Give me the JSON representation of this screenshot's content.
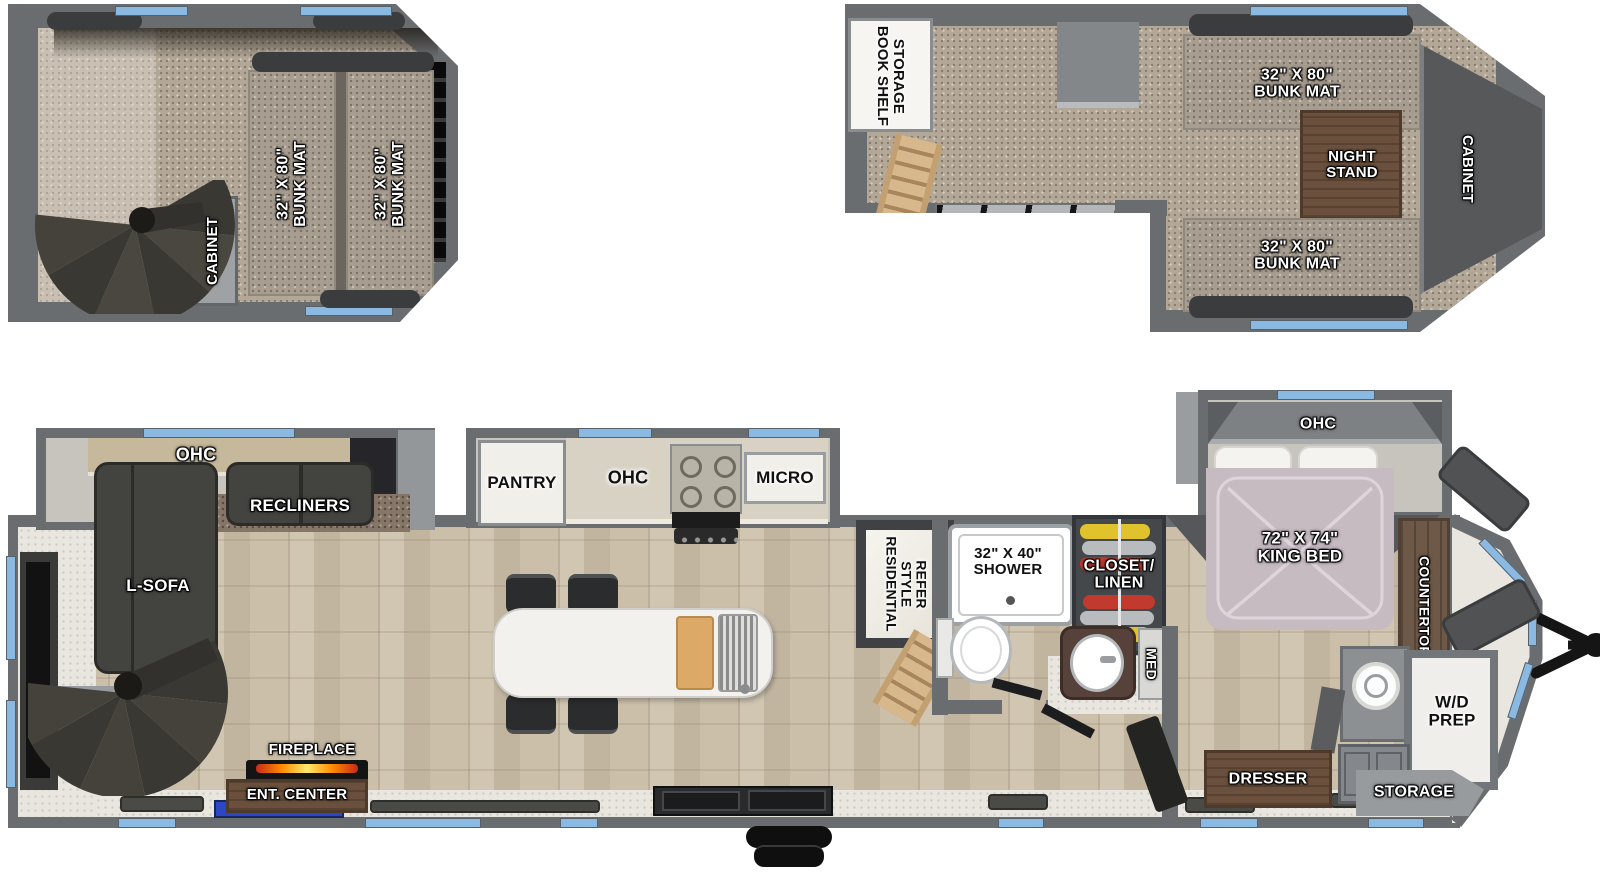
{
  "floorplan": {
    "rear_loft": {
      "cabinet": "CABINET",
      "bunk_left": "32\" X 80\"\nBUNK MAT",
      "bunk_right": "32\" X 80\"\nBUNK MAT"
    },
    "front_loft": {
      "book_shelf": "BOOK SHELF\nSTORAGE",
      "bunk_top": "32\" X 80\"\nBUNK MAT",
      "night_stand": "NIGHT\nSTAND",
      "cabinet": "CABINET",
      "bunk_bottom": "32\" X 80\"\nBUNK MAT"
    },
    "living": {
      "ohc": "OHC",
      "recliners": "RECLINERS",
      "l_sofa": "L-SOFA",
      "fireplace": "FIREPLACE",
      "ent_center": "ENT. CENTER"
    },
    "kitchen": {
      "pantry": "PANTRY",
      "ohc": "OHC",
      "micro": "MICRO",
      "refer": "RESIDENTIAL\nSTYLE\nREFER"
    },
    "bath": {
      "shower": "32\" X 40\"\nSHOWER",
      "closet": "CLOSET/\nLINEN",
      "med": "MED"
    },
    "bedroom": {
      "ohc": "OHC",
      "king_bed": "72\" X 74\"\nKING BED",
      "countertop": "COUNTERTOP",
      "wd_prep": "W/D\nPREP",
      "storage": "STORAGE",
      "dresser": "DRESSER"
    }
  },
  "colors": {
    "wall_gray": "#6a6d70",
    "window_blue": "#8ab9e2",
    "flame_orange": "#ff8a00",
    "ent_panel_blue": "#2b47c4",
    "closet_yellow": "#dfc22c",
    "closet_red": "#c23a2e",
    "bed_mauve": "#c7bbc2"
  }
}
